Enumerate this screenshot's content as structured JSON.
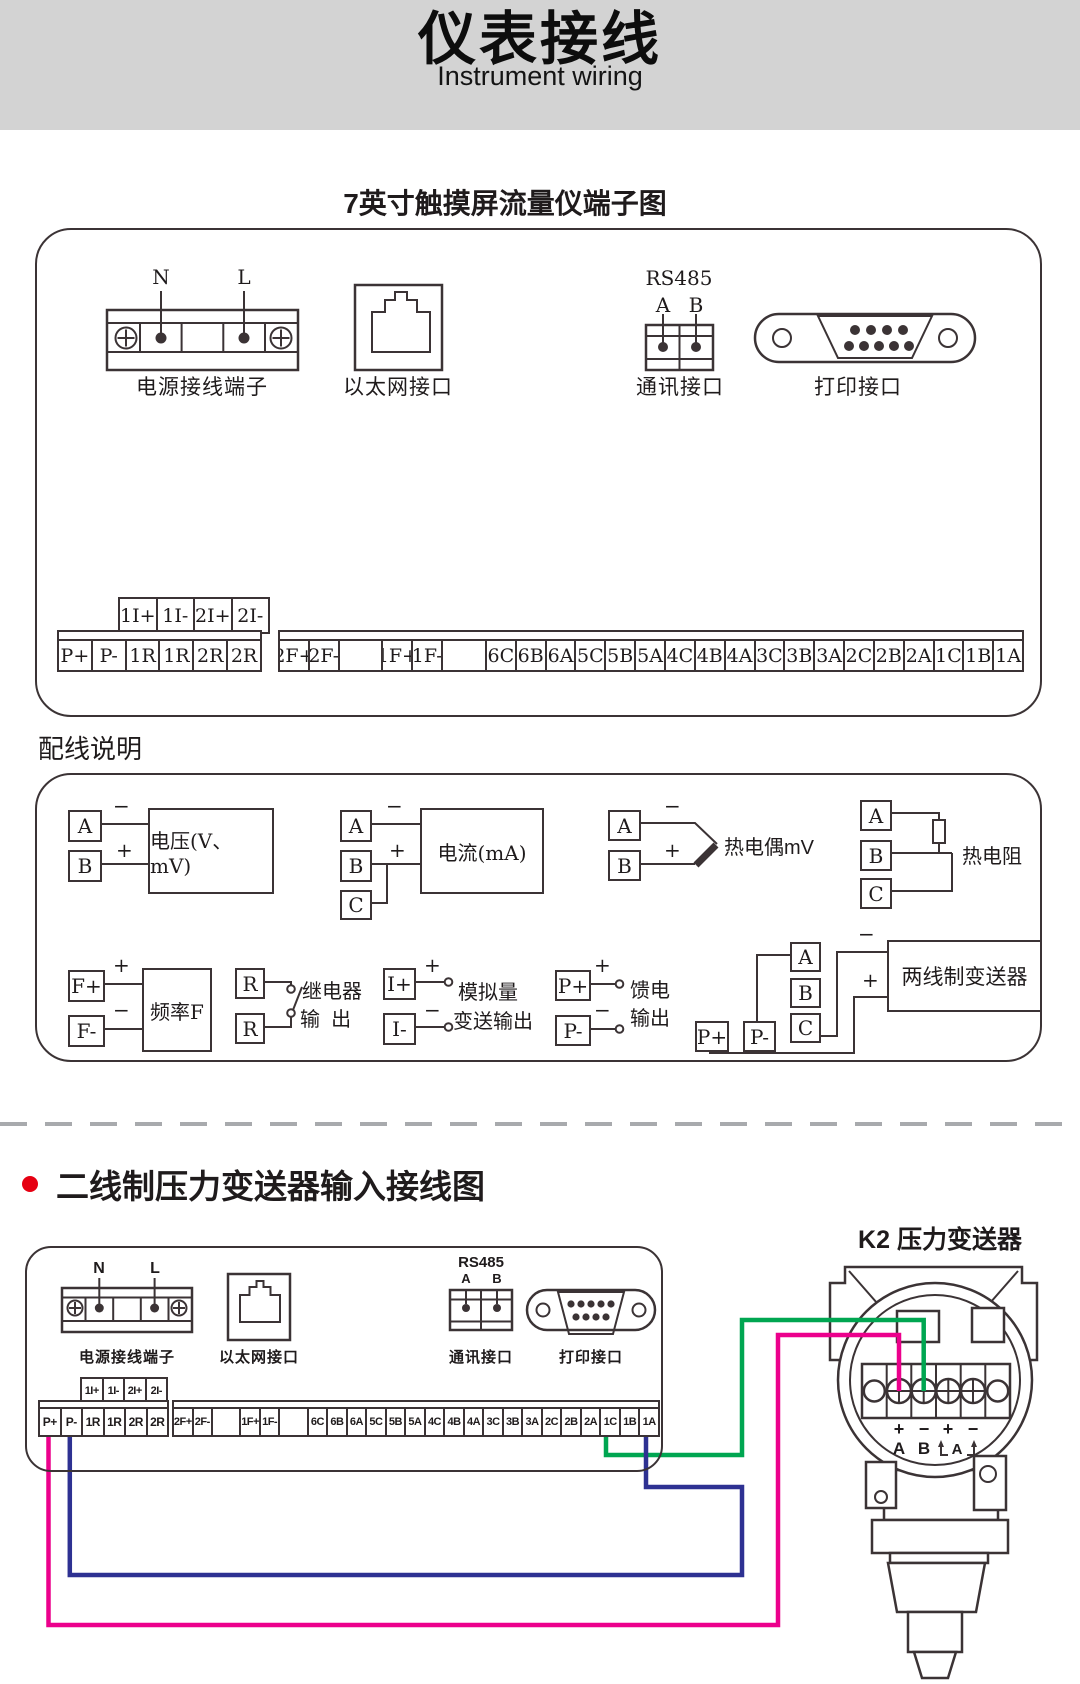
{
  "banner": {
    "title": "仪表接线",
    "subtitle": "Instrument wiring"
  },
  "section1": {
    "title": "7英寸触摸屏流量仪端子图",
    "power": {
      "n": "N",
      "l": "L",
      "caption": "电源接线端子"
    },
    "ethernet": {
      "caption": "以太网接口"
    },
    "comm": {
      "bus": "RS485",
      "a": "A",
      "b": "B",
      "caption": "通讯接口"
    },
    "printer": {
      "caption": "打印接口"
    },
    "strip": {
      "aux": [
        "1I+",
        "1I-",
        "2I+",
        "2I-"
      ],
      "group1": [
        "P+",
        "P-",
        "1R",
        "1R",
        "2R",
        "2R"
      ],
      "group2": [
        "2F+",
        "2F-",
        "",
        "1F+",
        "1F-",
        "",
        "6C",
        "6B",
        "6A",
        "5C",
        "5B",
        "5A",
        "4C",
        "4B",
        "4A",
        "3C",
        "3B",
        "3A",
        "2C",
        "2B",
        "2A",
        "1C",
        "1B",
        "1A"
      ]
    }
  },
  "section2": {
    "title": "配线说明",
    "voltage": {
      "a": "A",
      "b": "B",
      "minus": "−",
      "plus": "+",
      "label": "电压(V、mV)"
    },
    "current": {
      "a": "A",
      "b": "B",
      "c": "C",
      "minus": "−",
      "plus": "+",
      "label": "电流(mA)"
    },
    "thermocouple": {
      "a": "A",
      "b": "B",
      "minus": "−",
      "plus": "+",
      "label": "热电偶mV"
    },
    "rtd": {
      "a": "A",
      "b": "B",
      "c": "C",
      "label": "热电阻"
    },
    "frequency": {
      "fplus": "F+",
      "fminus": "F-",
      "plus": "+",
      "minus": "−",
      "label": "频率F"
    },
    "relay": {
      "r1": "R",
      "r2": "R",
      "label_line1": "继电器",
      "label_line2": "输  出"
    },
    "analog": {
      "iplus": "I+",
      "iminus": "I-",
      "plus": "+",
      "minus": "−",
      "label_line1": "模拟量",
      "label_line2": "变送输出"
    },
    "feed": {
      "pplus": "P+",
      "pminus": "P-",
      "plus": "+",
      "minus": "−",
      "label_line1": "馈电",
      "label_line2": "输出"
    },
    "two_wire": {
      "a": "A",
      "b": "B",
      "c": "C",
      "pplus": "P+",
      "pminus": "P-",
      "minus": "−",
      "plus": "+",
      "label": "两线制变送器"
    }
  },
  "section3": {
    "title": "二线制压力变送器输入接线图",
    "transmitter": {
      "title": "K2 压力变送器",
      "t1": "+",
      "t2": "−",
      "t3": "+",
      "t4": "−",
      "a": "A",
      "b": "B",
      "loop": "A"
    },
    "wires": {
      "green": "#00A651",
      "pink": "#EC008C",
      "blue": "#2E3192"
    }
  },
  "colors": {
    "banner_bg": "#d3d3d3",
    "line": "#3B3335",
    "bullet": "#E60012",
    "dash": "#A8AAAD"
  }
}
